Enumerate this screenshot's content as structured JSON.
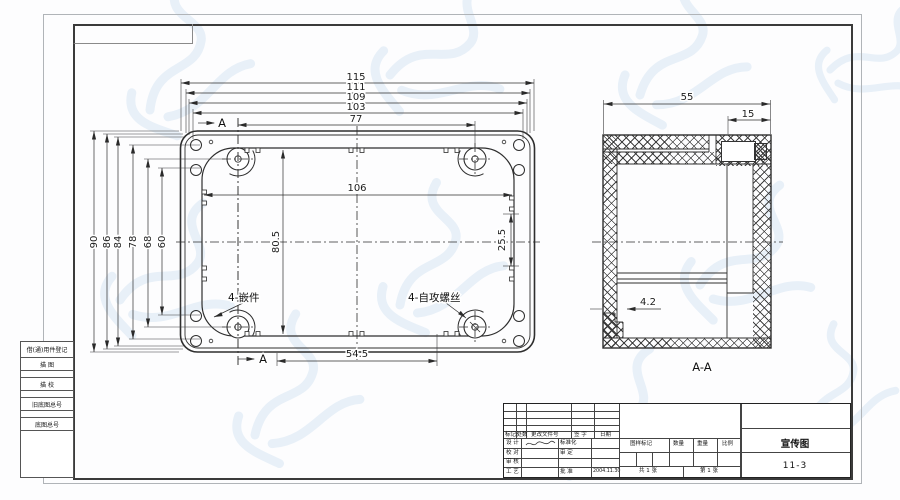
{
  "sheet": {
    "main_view": {
      "top_dims": [
        "115",
        "111",
        "109",
        "103",
        "77"
      ],
      "left_dims": [
        "90",
        "86",
        "84",
        "78",
        "68",
        "60"
      ],
      "dim_inner_width": "106",
      "dim_inner_height": "80.5",
      "dim_right_inner": "25.5",
      "dim_bottom": "54.5",
      "label_insert": "4-嵌件",
      "label_screw": "4-自攻螺丝",
      "section_marker": "A"
    },
    "section_view": {
      "dim_width": "55",
      "dim_lip": "15",
      "dim_step": "4.2",
      "label": "A-A"
    }
  },
  "title_block": {
    "revision_header": [
      "标记",
      "处数",
      "更改文件号",
      "签 字",
      "日期"
    ],
    "rows": [
      {
        "role": "设 计",
        "reviewer": "标准化"
      },
      {
        "role": "校 对",
        "reviewer": "审 定"
      },
      {
        "role": "审 核",
        "reviewer": ""
      },
      {
        "role": "工 艺",
        "reviewer": "批 准",
        "date": "2004.11.30"
      }
    ],
    "info_headers": [
      "图样标记",
      "数量",
      "重量",
      "比例"
    ],
    "sheet_total": "共 1 张",
    "sheet_number": "第 1 张",
    "drawing_title": "宣传图",
    "drawing_number": "11-3"
  },
  "margin_blocks": [
    "借(通)用件登记",
    "描 图",
    "描 校",
    "旧底图总号",
    "底图总号"
  ],
  "colors": {
    "line": "#2e2e2e",
    "watermark": "#d7e6f4",
    "frame": "#3a3a3a"
  }
}
